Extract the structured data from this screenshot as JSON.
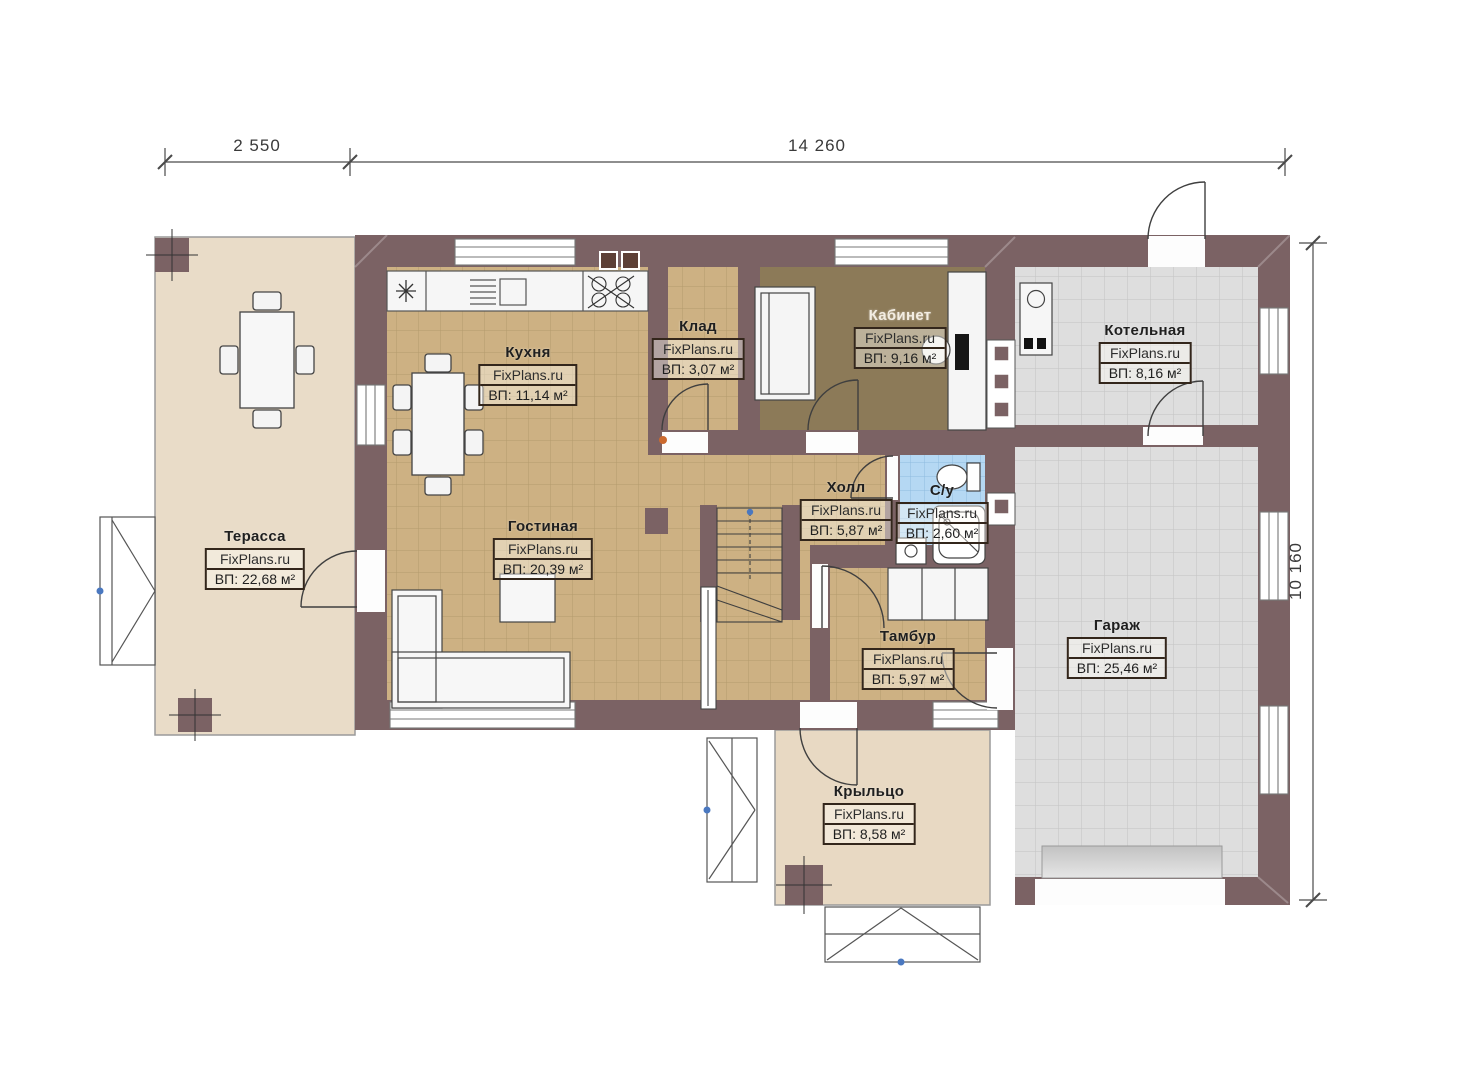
{
  "watermark": "FixPlans.ru",
  "dimensions": {
    "top_left": "2 550",
    "top_main": "14 260",
    "right_side": "10 160"
  },
  "rooms": [
    {
      "id": "terrace",
      "name": "Терасса",
      "watermark": "FixPlans.ru",
      "area": "ВП: 22,68 м²"
    },
    {
      "id": "kitchen",
      "name": "Кухня",
      "watermark": "FixPlans.ru",
      "area": "ВП: 11,14 м²"
    },
    {
      "id": "pantry",
      "name": "Клад",
      "watermark": "FixPlans.ru",
      "area": "ВП: 3,07 м²"
    },
    {
      "id": "office",
      "name": "Кабинет",
      "watermark": "FixPlans.ru",
      "area": "ВП: 9,16 м²"
    },
    {
      "id": "boiler_room",
      "name": "Котельная",
      "watermark": "FixPlans.ru",
      "area": "ВП: 8,16 м²"
    },
    {
      "id": "living_room",
      "name": "Гостиная",
      "watermark": "FixPlans.ru",
      "area": "ВП: 20,39 м²"
    },
    {
      "id": "hall",
      "name": "Холл",
      "watermark": "FixPlans.ru",
      "area": "ВП: 5,87 м²"
    },
    {
      "id": "bathroom",
      "name": "С/у",
      "watermark": "FixPlans.ru",
      "area": "ВП: 2,60 м²"
    },
    {
      "id": "vestibule",
      "name": "Тамбур",
      "watermark": "FixPlans.ru",
      "area": "ВП: 5,97 м²"
    },
    {
      "id": "garage",
      "name": "Гараж",
      "watermark": "FixPlans.ru",
      "area": "ВП: 25,46 м²"
    },
    {
      "id": "porch",
      "name": "Крыльцо",
      "watermark": "FixPlans.ru",
      "area": "ВП: 8,58 м²"
    }
  ],
  "colors": {
    "wall": "#7b6264",
    "floor_wood": "#cdb183",
    "floor_terrace": "#e9dcc8",
    "floor_porch": "#e8d9c3",
    "floor_office": "#8c7a58",
    "floor_tile_gray": "#dedede",
    "floor_tile_blue": "#b5d8f3"
  }
}
